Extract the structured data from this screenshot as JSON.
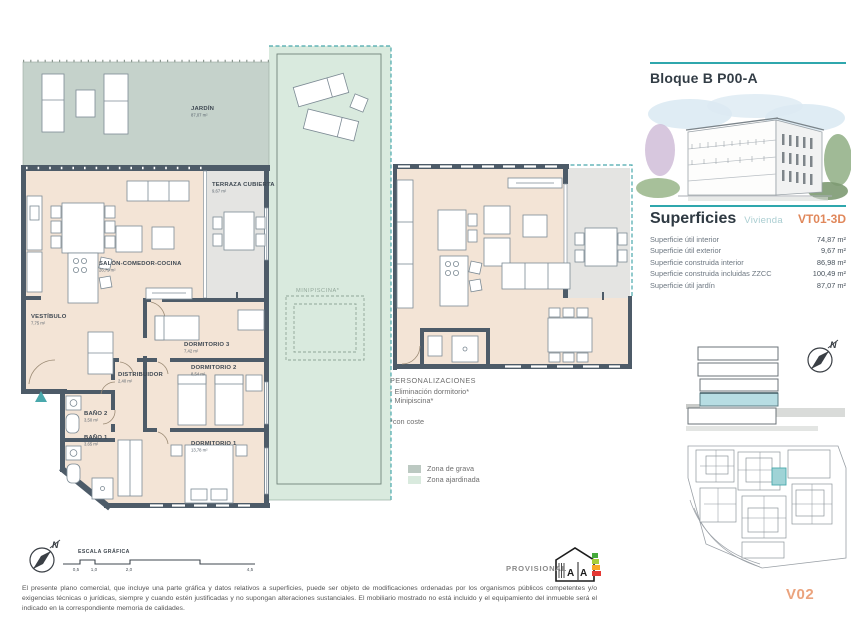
{
  "doc": {
    "block_title": "Bloque B P00-A",
    "superficies_title": "Superficies",
    "superficies_subtitle": "Vivienda",
    "unit_code": "VT01-3D",
    "version": "V02"
  },
  "superficies_rows": [
    {
      "label": "Superficie útil interior",
      "value": "74,87 m²"
    },
    {
      "label": "Superficie útil exterior",
      "value": "9,67 m²"
    },
    {
      "label": "Superficie construida interior",
      "value": "86,98 m²"
    },
    {
      "label": "Superficie construida incluidas ZZCC",
      "value": "100,49 m²"
    },
    {
      "label": "Superficie útil jardín",
      "value": "87,07 m²"
    }
  ],
  "plan_rooms": {
    "jardin": {
      "name": "JARDÍN",
      "area": "87,07 m²"
    },
    "terraza": {
      "name": "TERRAZA CUBIERTA",
      "area": "9,67 m²"
    },
    "salon": {
      "name": "SALÓN-COMEDOR-COCINA",
      "area": "26,75 m²"
    },
    "vestibulo": {
      "name": "VESTÍBULO",
      "area": "7,75 m²"
    },
    "dormitorio3": {
      "name": "DORMITORIO 3",
      "area": "7,42 m²"
    },
    "distribuidor": {
      "name": "DISTRIBUIDOR",
      "area": "2,40 m²"
    },
    "dormitorio2": {
      "name": "DORMITORIO 2",
      "area": "8,54 m²"
    },
    "bano2": {
      "name": "BAÑO 2",
      "area": "3,50 m²"
    },
    "bano1": {
      "name": "BAÑO 1",
      "area": "3,65 m²"
    },
    "dormitorio1": {
      "name": "DORMITORIO 1",
      "area": "13,78 m²"
    },
    "minipiscina": {
      "name": "MINIPISCINA*"
    }
  },
  "personalizaciones": {
    "title": "PERSONALIZACIONES",
    "items": [
      "- Eliminación dormitorio*",
      "- Minipiscina*"
    ],
    "note": "*con coste"
  },
  "legend": {
    "items": [
      {
        "label": "Zona de grava",
        "color": "#bcc9c2"
      },
      {
        "label": "Zona ajardinada",
        "color": "#d9eade"
      }
    ]
  },
  "scale_bar": {
    "title": "ESCALA GRÁFICA",
    "ticks": [
      "0,5",
      "1,0",
      "2,0",
      "4,5"
    ]
  },
  "compass": {
    "letter": "N"
  },
  "energy": {
    "letter_left": "A",
    "letter_right": "A"
  },
  "footer": {
    "provisional": "PROVISIONAL",
    "disclaimer": "El presente plano comercial, que incluye una parte gráfica y datos relativos a superficies, puede ser objeto de modificaciones ordenadas por los organismos públicos competentes y/o exigencias técnicas o jurídicas, siempre y cuando estén justificadas y no supongan alteraciones sustanciales. El mobiliario mostrado no está incluido y el equipamiento del inmueble será el indicado en la correspondiente memoria de calidades."
  },
  "colors": {
    "accent_teal": "#2fa7ad",
    "accent_orange": "#e0875a",
    "version_orange": "#eba37d",
    "wall": "#4d5b68",
    "floor_beige": "#f3e4d6",
    "terrace_gray": "#e4e4e2",
    "gravel_zone": "#c5d2cb",
    "garden_zone": "#d9eade",
    "section_highlight": "#b7dde3"
  }
}
